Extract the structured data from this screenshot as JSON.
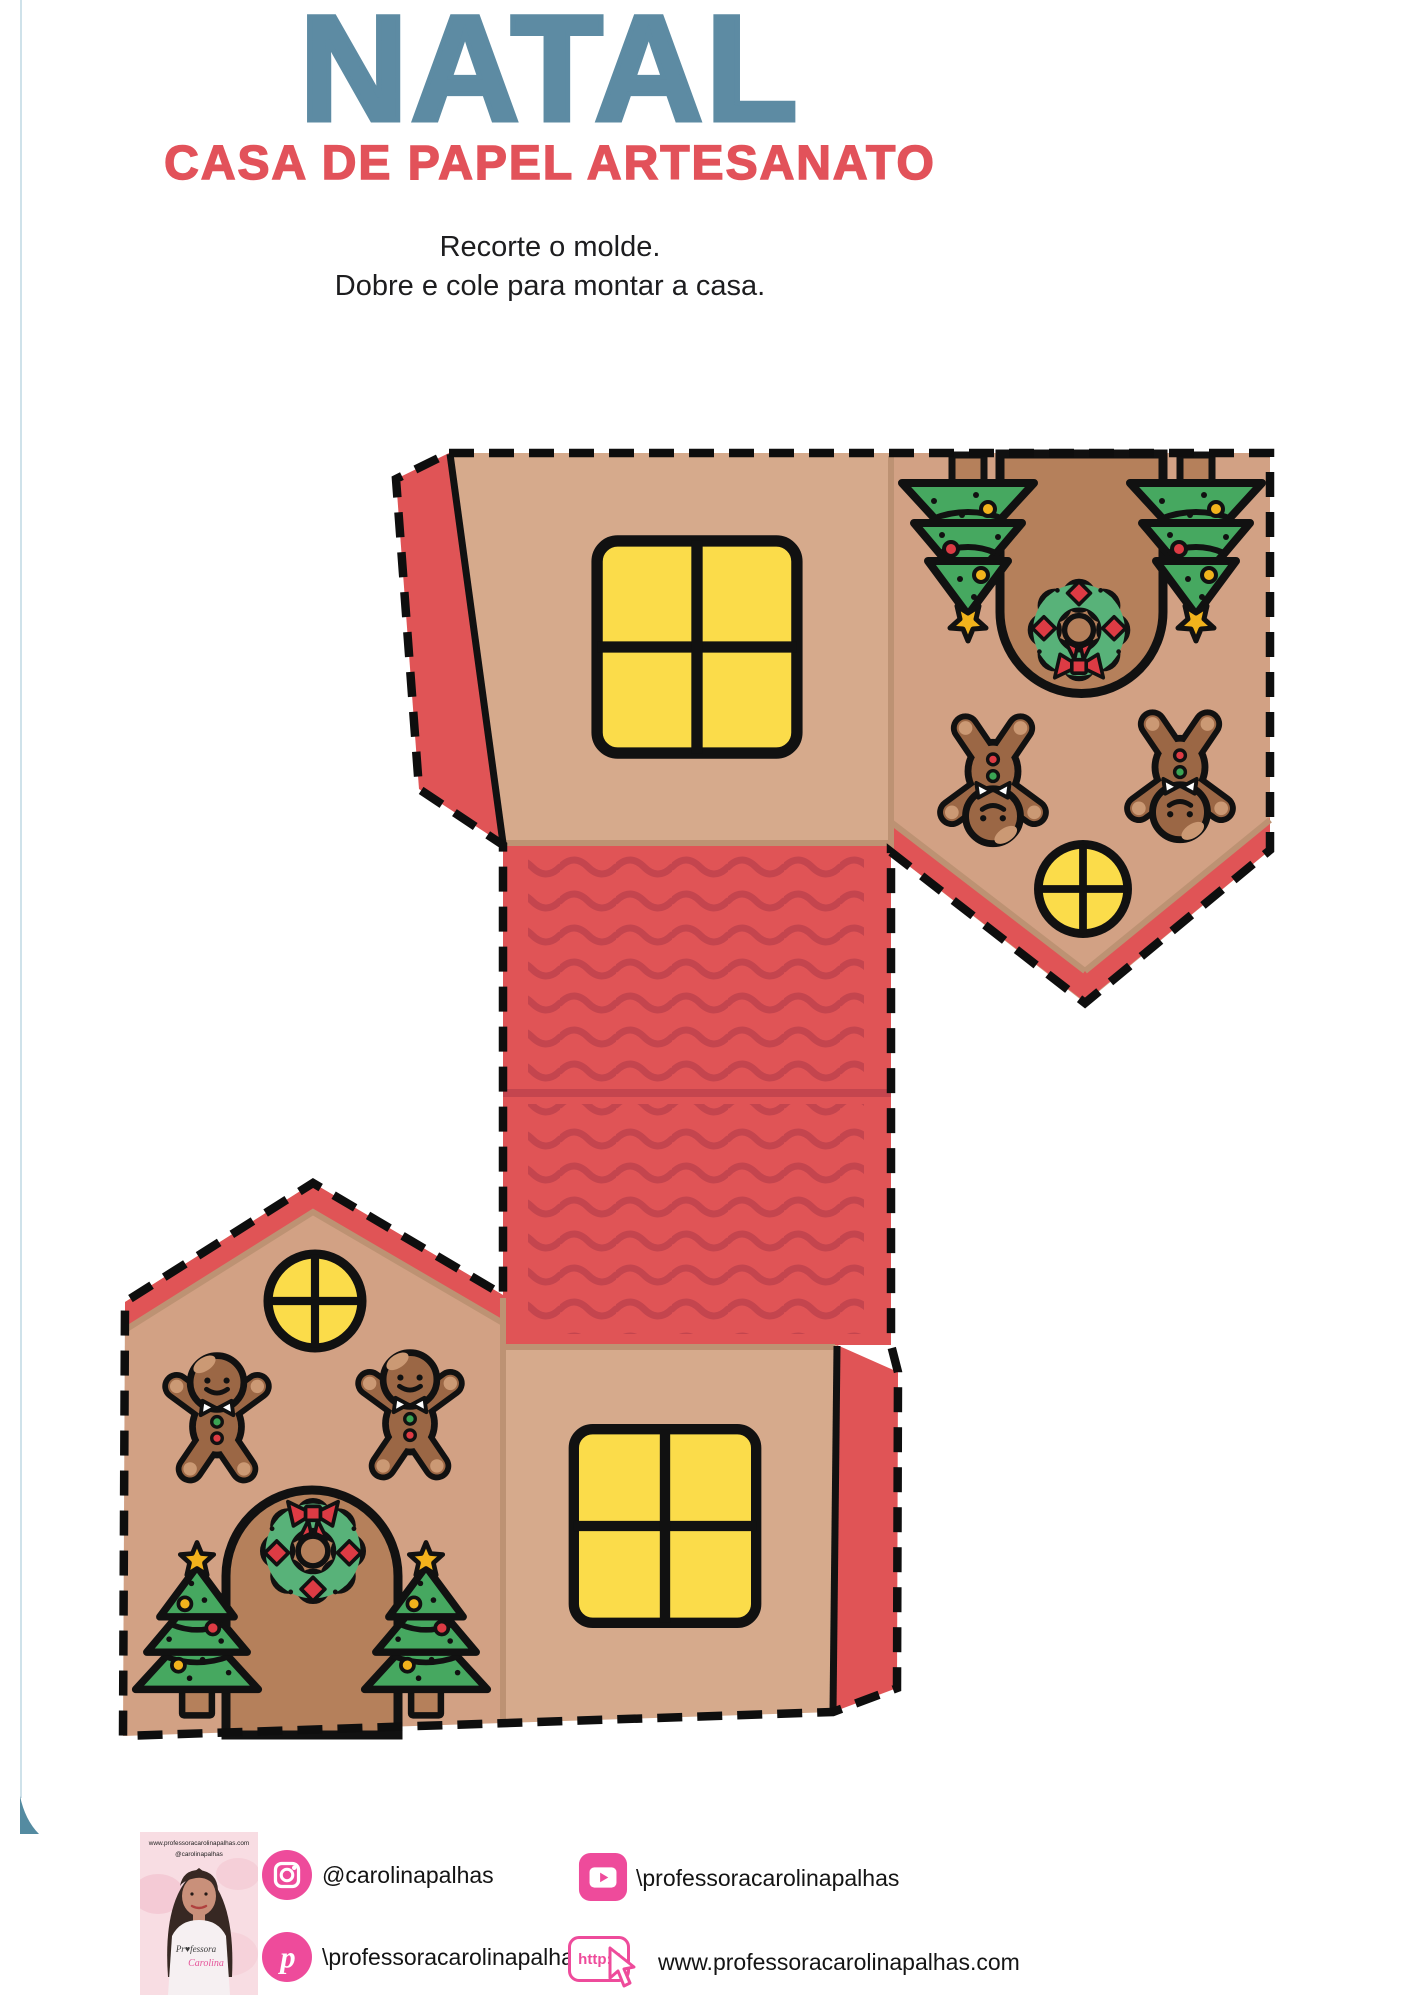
{
  "page": {
    "title": "NATAL",
    "subtitle": "CASA DE PAPEL ARTESANATO",
    "instruction_line1": "Recorte o molde.",
    "instruction_line2": "Dobre e cole para montar a casa."
  },
  "template": {
    "kind": "paper-house-cutout",
    "decorations": [
      "christmas-tree",
      "gingerbread-man",
      "christmas-wreath",
      "four-pane-window",
      "round-window",
      "arched-door",
      "wavy-roof-tiles",
      "glue-tabs"
    ]
  },
  "footer": {
    "photo": {
      "caption_line1": "www.professoracarolinapalhas.com",
      "caption_line2": "@carolinapalhas",
      "shirt_line1": "Pr♥fessora",
      "shirt_line2": "Carolina"
    },
    "instagram_handle": "@carolinapalhas",
    "youtube_handle": "\\professoracarolinapalhas",
    "pinterest_handle": "\\professoracarolinapalhas",
    "website_badge": "http://",
    "website_url": "www.professoracarolinapalhas.com"
  },
  "colors": {
    "title-blue": "#5d8ba3",
    "accent-red": "#e2525a",
    "red": "#e05456",
    "wave-red": "#c4454e",
    "tan-wall": "#d6aa8c",
    "tan-gable": "#d2a184",
    "shadow-tan": "#bd9273",
    "brown-door": "#b5805b",
    "window-yellow": "#fbdc4a",
    "tree-green": "#46a860",
    "wreath-green": "#58b279",
    "ginger-brown": "#9b6745",
    "ginger-light": "#cb9974",
    "button-green": "#3aa353",
    "deco-red": "#dd3b44",
    "ornament-yellow": "#f2b31c",
    "pink": "#ee4b9b",
    "photo-pink": "#f8dde3",
    "edge-blue": "#cfe2ea",
    "corner-teal": "#548ba1",
    "ink": "#0e0e0e"
  }
}
